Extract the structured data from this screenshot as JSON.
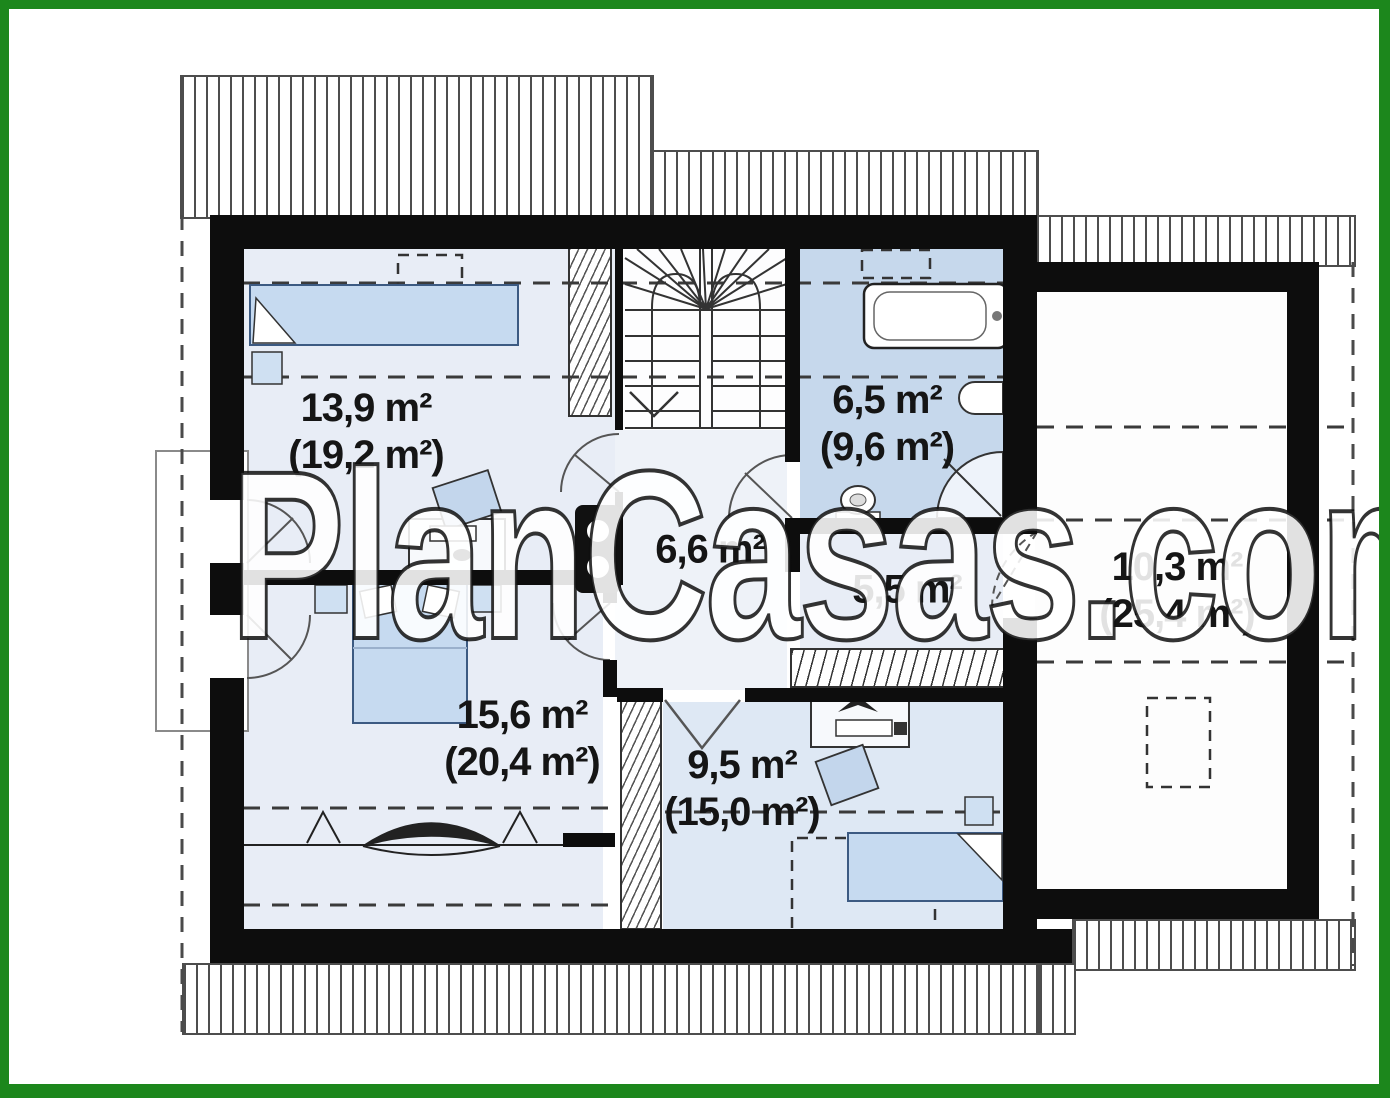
{
  "watermark": "PlanCasas.com",
  "rooms": [
    {
      "name": "bedroom-top-left",
      "area": "13,9 m²",
      "floor_area": "(19,2 m²)"
    },
    {
      "name": "bathroom",
      "area": "6,5 m²",
      "floor_area": "(9,6 m²)"
    },
    {
      "name": "hall",
      "area": "6,6 m²",
      "floor_area": ""
    },
    {
      "name": "closet",
      "area": "5,5 m²",
      "floor_area": ""
    },
    {
      "name": "attic-storage",
      "area": "10,3 m²",
      "floor_area": "(25,4 m²)"
    },
    {
      "name": "bedroom-bottom-left",
      "area": "15,6 m²",
      "floor_area": "(20,4 m²)"
    },
    {
      "name": "bedroom-bottom-right",
      "area": "9,5 m²",
      "floor_area": "(15,0 m²)"
    }
  ],
  "colors": {
    "frame_green": "#1c871c",
    "wall_black": "#0d0d0d",
    "room_fill": "#e8edf6",
    "bathroom_fill": "#c6d8ec",
    "bedroom3_fill": "#dee8f4",
    "hall_fill": "#eef2f8",
    "storage_fill": "#fdfdfd",
    "furniture_blue": "#c6daf0",
    "hatch_line": "#4d4d4d"
  }
}
